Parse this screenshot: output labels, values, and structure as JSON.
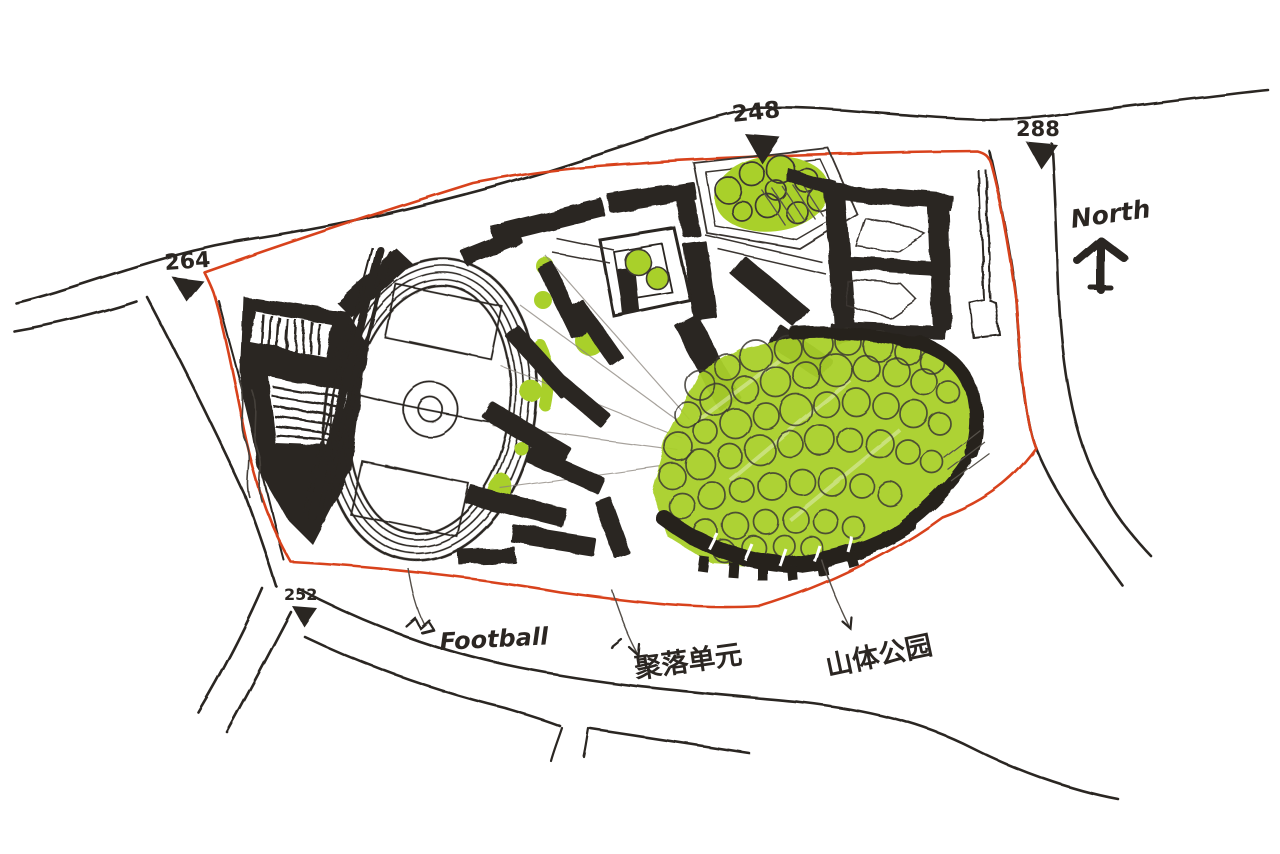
{
  "colors": {
    "paper": "#ffffff",
    "ink": "#2b2622",
    "pencil_gray": "#6b655d",
    "boundary_red": "#d8431f",
    "park_green": "#a9d02b"
  },
  "compass": {
    "label": "North"
  },
  "spot_elevations": [
    {
      "position": "top-center",
      "value": "248"
    },
    {
      "position": "northeast",
      "value": "288"
    },
    {
      "position": "west",
      "value": "264"
    },
    {
      "position": "southwest",
      "value": "252"
    }
  ],
  "annotations": [
    {
      "id": "football",
      "text": "Football"
    },
    {
      "id": "settlement-unit",
      "text": "聚落单元"
    },
    {
      "id": "mountain-park",
      "text": "山体公园"
    }
  ]
}
